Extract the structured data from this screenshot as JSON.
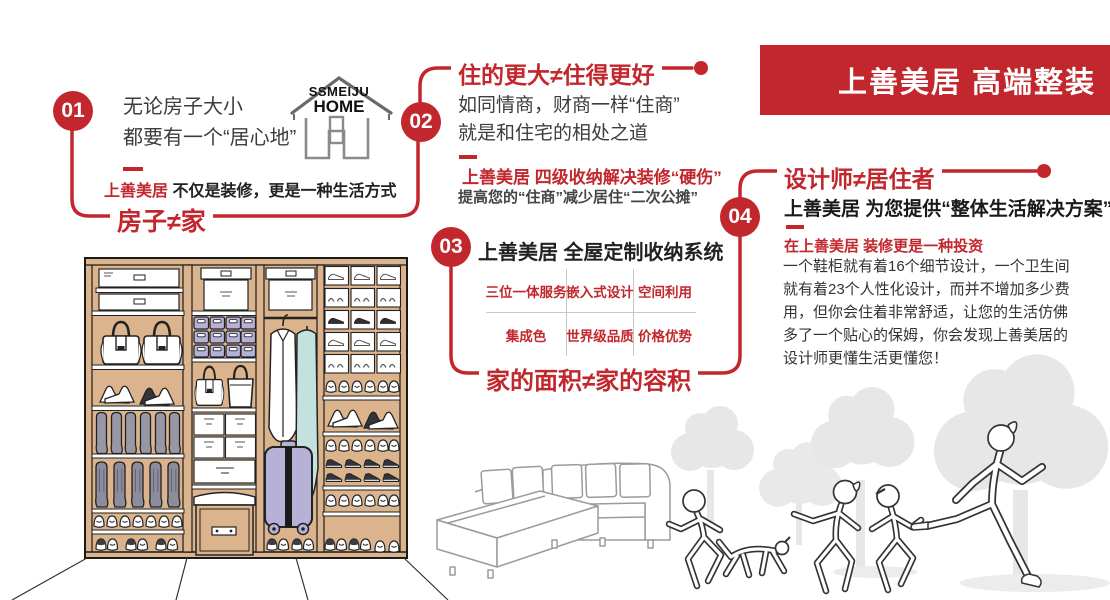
{
  "accent": "#c2272d",
  "banner": {
    "title": "上善美居 高端整装"
  },
  "logo": {
    "line1": "SSMEIJU",
    "line2": "HOME"
  },
  "sections": {
    "s1": {
      "number": "01",
      "line1": "无论房子大小",
      "line2": "都要有一个“居心地”",
      "brand": "上善美居",
      "brand_rest": "不仅是装修，更是一种生活方式",
      "tagline": "房子≠家"
    },
    "s2": {
      "number": "02",
      "heading": "住的更大≠住得更好",
      "line1": "如同情商，财商一样“住商”",
      "line2": "就是和住宅的相处之道",
      "highlight": "上善美居 四级收纳解决装修“硬伤”",
      "note": "提高您的“住商”减少居住“二次公摊”"
    },
    "s3": {
      "number": "03",
      "heading": "上善美居 全屋定制收纳系统",
      "grid": [
        [
          "三位一体服务",
          "嵌入式设计",
          "空间利用"
        ],
        [
          "集成色",
          "世界级品质",
          "价格优势"
        ]
      ],
      "tagline": "家的面积≠家的容积"
    },
    "s4": {
      "number": "04",
      "heading": "设计师≠居住者",
      "promise": "上善美居 为您提供“整体生活解决方案”",
      "invest": "在上善美居 装修更是一种投资",
      "paragraph": "一个鞋柜就有着16个细节设计，一个卫生间就有着23个人性化设计，而并不增加多少费用，但你会住着非常舒适，让您的生活仿佛多了一个贴心的保姆，你会发现上善美居的设计师更懂生活更懂您！"
    }
  },
  "colors": {
    "wood": "#dbb48e",
    "lavender": "#b6b1d7",
    "teal": "#c3e1dd",
    "boot_gray": "#9897a6",
    "silhouette_gray": "#e7e7e7"
  }
}
